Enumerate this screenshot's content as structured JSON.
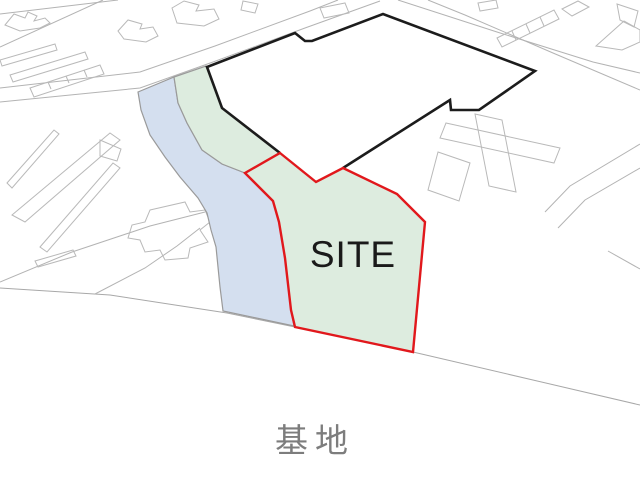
{
  "page": {
    "width": 640,
    "height": 503,
    "background": "#ffffff"
  },
  "labels": {
    "site": "SITE",
    "caption": "基地"
  },
  "colors": {
    "site_fill": "#ddecdf",
    "river_fill": "#d4dfef",
    "site_boundary_red": "#e1181c",
    "parcel_boundary_black": "#1c1c1c",
    "building_line_gray": "#b9b9b9",
    "road_line_gray": "#b3b3b3",
    "area_edge_gray": "#9a9a9a",
    "site_label_color": "#1a1a1a",
    "caption_color": "#7d7d7d"
  },
  "map": {
    "shapes": [
      {
        "name": "road-upper-a",
        "type": "polyline",
        "points": "0,14 118,0",
        "stroke": "#b3b3b3",
        "width": 1
      },
      {
        "name": "road-upper-b",
        "type": "polyline",
        "points": "0,47 103,0",
        "stroke": "#b3b3b3",
        "width": 1
      },
      {
        "name": "road-main-upper",
        "type": "polyline",
        "points": "0,88 140,72 215,46 310,11 338,0",
        "stroke": "#b3b3b3",
        "width": 1
      },
      {
        "name": "road-main-lower",
        "type": "polyline",
        "points": "0,102 140,88 213,62 305,28 380,1",
        "stroke": "#b3b3b3",
        "width": 1
      },
      {
        "name": "road-ne-a",
        "type": "polyline",
        "points": "398,0 497,32 593,62 640,73",
        "stroke": "#b3b3b3",
        "width": 1
      },
      {
        "name": "road-ne-b",
        "type": "polyline",
        "points": "428,0 465,15 553,53 640,90",
        "stroke": "#b3b3b3",
        "width": 1
      },
      {
        "name": "road-east-a",
        "type": "polyline",
        "points": "640,144 570,186 545,212",
        "stroke": "#b3b3b3",
        "width": 1
      },
      {
        "name": "road-east-b",
        "type": "polyline",
        "points": "640,168 585,200 558,228",
        "stroke": "#b3b3b3",
        "width": 1
      },
      {
        "name": "road-east-c",
        "type": "polyline",
        "points": "608,251 640,269",
        "stroke": "#b3b3b3",
        "width": 1
      },
      {
        "name": "road-bottom",
        "type": "polyline",
        "points": "0,288 110,295 227,313 295,327 413,352 640,405",
        "stroke": "#a8a8a8",
        "width": 1
      },
      {
        "name": "road-sw-a",
        "type": "polyline",
        "points": "0,282 72,252 150,226 205,212",
        "stroke": "#b3b3b3",
        "width": 1
      },
      {
        "name": "road-sw-b",
        "type": "polyline",
        "points": "95,294 145,268 177,246 200,228",
        "stroke": "#b3b3b3",
        "width": 1
      },
      {
        "name": "building-nw-blob-1",
        "type": "polygon",
        "points": "5,25 14,14 25,18 28,12 37,16 34,21 45,18 50,23 40,28 20,31",
        "stroke": "#b9b9b9",
        "width": 1
      },
      {
        "name": "building-nw-blob-2",
        "type": "polygon",
        "points": "118,31 128,20 142,24 140,29 153,27 158,36 146,42 124,39",
        "stroke": "#b9b9b9",
        "width": 1
      },
      {
        "name": "building-n-blob",
        "type": "polygon",
        "points": "172,8 184,1 199,5 196,11 214,9 219,19 204,26 177,23",
        "stroke": "#b9b9b9",
        "width": 1
      },
      {
        "name": "building-n-small",
        "type": "polygon",
        "points": "243,1 258,4 255,13 241,10",
        "stroke": "#b9b9b9",
        "width": 1
      },
      {
        "name": "building-w-strip-1",
        "type": "polygon",
        "points": "0,60 55,44 57,50 2,66",
        "stroke": "#b9b9b9",
        "width": 1
      },
      {
        "name": "building-w-strip-2",
        "type": "polygon",
        "points": "10,75 85,52 88,59 13,82",
        "stroke": "#b9b9b9",
        "width": 1
      },
      {
        "name": "building-w-rowhouse",
        "type": "polygon",
        "points": "30,88 100,65 104,74 34,97",
        "stroke": "#b9b9b9",
        "width": 1
      },
      {
        "name": "building-w-rowhouse-divider",
        "type": "polyline",
        "points": "48,82 51,89",
        "stroke": "#b9b9b9",
        "width": 1
      },
      {
        "name": "building-w-rowhouse-divider",
        "type": "polyline",
        "points": "66,76 69,83",
        "stroke": "#b9b9b9",
        "width": 1
      },
      {
        "name": "building-w-rowhouse-divider",
        "type": "polyline",
        "points": "84,70 87,77",
        "stroke": "#b9b9b9",
        "width": 1
      },
      {
        "name": "building-sw-strip-1",
        "type": "polygon",
        "points": "7,183 54,130 59,134 12,188",
        "stroke": "#b9b9b9",
        "width": 1
      },
      {
        "name": "building-sw-strip-2",
        "type": "polygon",
        "points": "12,215 110,133 120,140 25,222",
        "stroke": "#b9b9b9",
        "width": 1
      },
      {
        "name": "building-sw-strip-3",
        "type": "polygon",
        "points": "40,247 113,163 120,168 47,252",
        "stroke": "#b9b9b9",
        "width": 1
      },
      {
        "name": "building-sw-strip-4",
        "type": "polygon",
        "points": "35,261 73,250 76,256 38,267",
        "stroke": "#b9b9b9",
        "width": 1
      },
      {
        "name": "building-sw-cross",
        "type": "polygon",
        "points": "150,210 185,202 190,212 205,210 210,222 200,230 208,242 190,248 188,258 165,260 160,250 145,252 140,240 128,238 132,225 145,222",
        "stroke": "#b9b9b9",
        "width": 1
      },
      {
        "name": "building-w-small",
        "type": "polygon",
        "points": "100,140 121,149 117,161 100,156",
        "stroke": "#b9b9b9",
        "width": 1
      },
      {
        "name": "building-e-complex-bar",
        "type": "polygon",
        "points": "446,123 560,148 554,163 440,138",
        "stroke": "#b9b9b9",
        "width": 1
      },
      {
        "name": "building-e-complex-wing",
        "type": "polygon",
        "points": "475,114 502,120 516,192 489,186",
        "stroke": "#b9b9b9",
        "width": 1
      },
      {
        "name": "building-e-complex-block",
        "type": "polygon",
        "points": "438,152 470,163 459,201 428,190",
        "stroke": "#b9b9b9",
        "width": 1
      },
      {
        "name": "building-ne-rowhouse",
        "type": "polygon",
        "points": "497,38 554,10 559,19 502,47",
        "stroke": "#b9b9b9",
        "width": 1
      },
      {
        "name": "building-ne-rowhouse-divider",
        "type": "polyline",
        "points": "512,31 516,40",
        "stroke": "#b9b9b9",
        "width": 1
      },
      {
        "name": "building-ne-rowhouse-divider",
        "type": "polyline",
        "points": "526,24 530,33",
        "stroke": "#b9b9b9",
        "width": 1
      },
      {
        "name": "building-ne-rowhouse-divider",
        "type": "polyline",
        "points": "540,17 544,26",
        "stroke": "#b9b9b9",
        "width": 1
      },
      {
        "name": "building-ne-small-1",
        "type": "polygon",
        "points": "562,9 578,1 589,7 572,16",
        "stroke": "#b9b9b9",
        "width": 1
      },
      {
        "name": "building-n-quad",
        "type": "polygon",
        "points": "320,8 345,3 349,13 324,18",
        "stroke": "#b9b9b9",
        "width": 1
      },
      {
        "name": "building-ne-small-2",
        "type": "polygon",
        "points": "478,3 496,0 498,8 480,11",
        "stroke": "#b9b9b9",
        "width": 1
      },
      {
        "name": "building-ne-corner",
        "type": "polygon",
        "points": "617,4 638,11 634,27 620,20",
        "stroke": "#b9b9b9",
        "width": 1
      },
      {
        "name": "building-e-large",
        "type": "polygon",
        "points": "596,46 624,21 640,30 640,42 622,50",
        "stroke": "#b9b9b9",
        "width": 1
      },
      {
        "name": "parcel-fill",
        "type": "polygon",
        "points": "207,67 295,33 305,41 312,41 383,14 535,71 479,110 451,110 450,100 343,168 316,182 280,153 222,108",
        "fill": "#ffffff"
      },
      {
        "name": "river",
        "type": "polygon",
        "points": "138,92 174,77 178,103 187,123 202,150 222,164 245,173 273,201 279,222 285,258 291,310 294,326 223,311 220,287 216,247 211,230 207,213 198,198 180,177 165,157 150,135 141,110",
        "fill": "#d4dfef",
        "stroke": "#9a9a9a",
        "width": 1.2
      },
      {
        "name": "site-greenspace",
        "type": "polygon",
        "points": "174,77 206,66 222,108 280,153 316,182 343,168 397,194 425,222 413,352 295,327 291,310 285,258 279,222 273,201 245,173 222,164 202,150 187,123 178,103",
        "fill": "#ddecdf",
        "stroke": "#9a9a9a",
        "width": 1.2
      },
      {
        "name": "parcel-boundary",
        "type": "polyline",
        "points": "280,153 222,108 207,67 295,33 305,41 312,41 383,14 535,71 479,110 451,110 450,100 343,168",
        "stroke": "#1c1c1c",
        "width": 2.6
      },
      {
        "name": "site-boundary",
        "type": "polygon",
        "points": "280,153 316,182 343,168 397,194 425,222 413,352 295,327 291,310 285,258 279,222 273,201 245,173",
        "stroke": "#e1181c",
        "width": 2.4
      }
    ]
  }
}
